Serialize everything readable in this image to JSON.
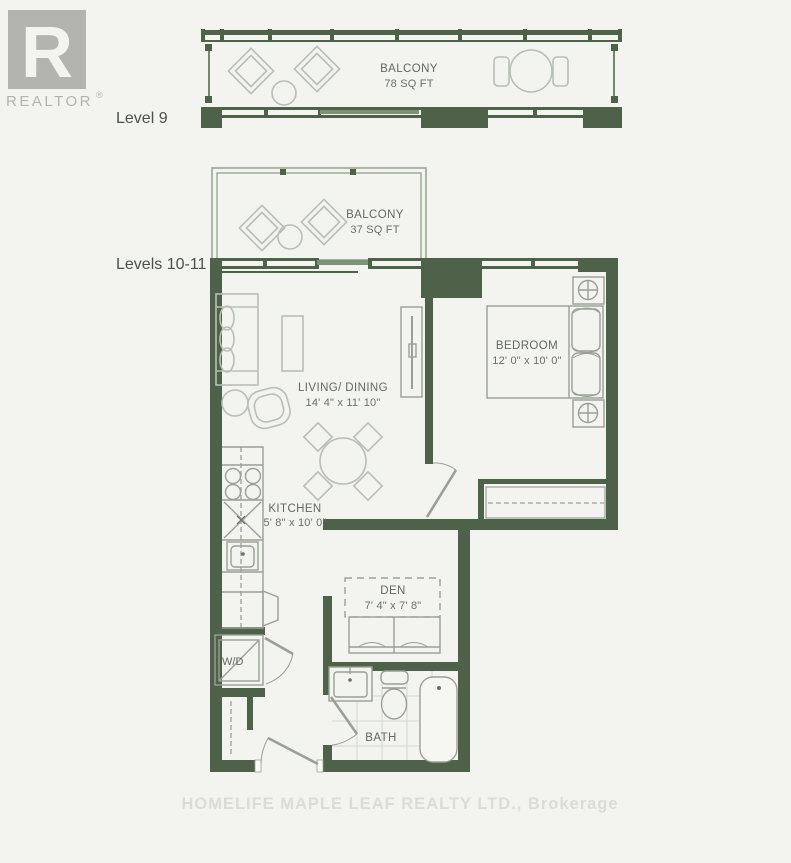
{
  "branding": {
    "logo_letter": "R",
    "logo_text": "REALTOR",
    "logo_registered": "®",
    "watermark": "HOMELIFE MAPLE LEAF REALTY LTD., Brokerage"
  },
  "levels": {
    "level_9": "Level 9",
    "levels_10_11": "Levels 10-11"
  },
  "rooms": {
    "balcony_level9": {
      "name": "BALCONY",
      "area": "78 SQ FT"
    },
    "balcony_levels1011": {
      "name": "BALCONY",
      "area": "37 SQ FT"
    },
    "living_dining": {
      "name": "LIVING/ DINING",
      "dims": "14' 4\" x 11' 10\""
    },
    "bedroom": {
      "name": "BEDROOM",
      "dims": "12' 0\" x 10' 0\""
    },
    "kitchen": {
      "name": "KITCHEN",
      "dims": "5' 8\" x 10' 0\""
    },
    "den": {
      "name": "DEN",
      "dims": "7' 4\" x 7' 8\""
    },
    "bath": {
      "name": "BATH"
    },
    "laundry": {
      "name": "W/D"
    }
  },
  "colors": {
    "wall_green": "#4e6149",
    "accent_light_green": "#7d9378",
    "frame_green": "#9aa896",
    "furniture_gray": "#b9bfb5",
    "label_gray": "#63695f",
    "logo_gray": "#b3b3b0",
    "watermark_gray": "#dcdcd7",
    "background": "#f3f3ef"
  }
}
